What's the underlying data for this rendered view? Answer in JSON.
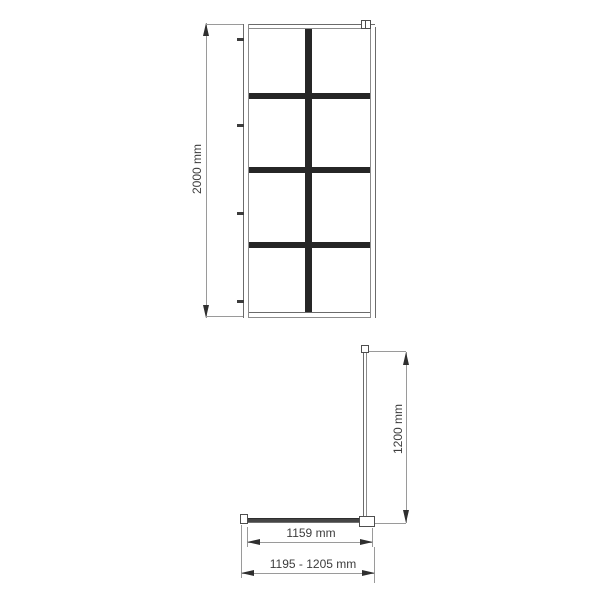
{
  "drawing_type": "shower-screen-technical-drawing",
  "front_view": {
    "height_label": "2000 mm",
    "grid_rows": 4,
    "grid_columns": 2,
    "wall_anchor_count": 4
  },
  "side_view": {
    "height_label": "1200 mm",
    "glass_width_label": "1159 mm",
    "installation_width_label": "1195 - 1205 mm"
  },
  "colors": {
    "line": "#6b6b6b",
    "frame": "#8c8c8c",
    "dim": "#9a9a9a",
    "bar": "#262626",
    "arrow": "#2f2f2f",
    "text": "#3d3d3d",
    "hw": "#454545"
  }
}
